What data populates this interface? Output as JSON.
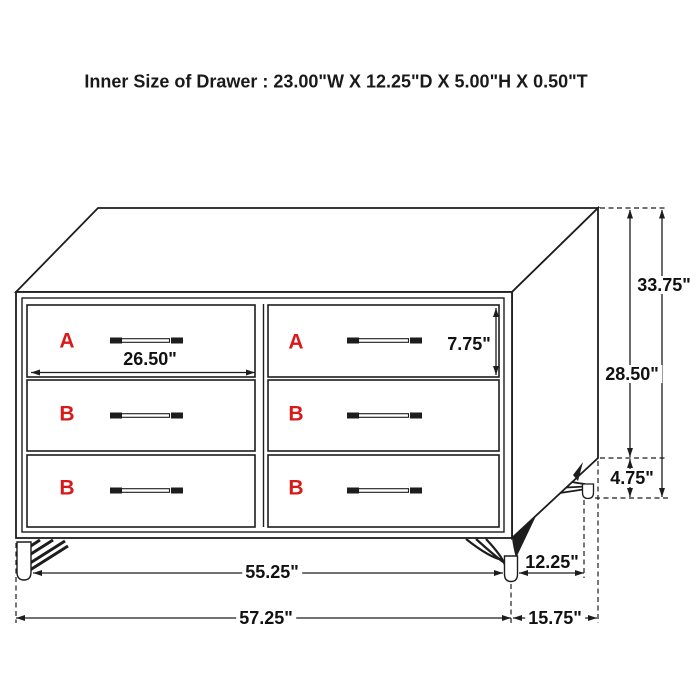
{
  "title": "Inner Size of Drawer : 23.00\"W X 12.25\"D X 5.00\"H X 0.50\"T",
  "drawers": [
    {
      "position": "top-left",
      "label": "A"
    },
    {
      "position": "top-right",
      "label": "A"
    },
    {
      "position": "middle-left",
      "label": "B"
    },
    {
      "position": "middle-right",
      "label": "B"
    },
    {
      "position": "bottom-left",
      "label": "B"
    },
    {
      "position": "bottom-right",
      "label": "B"
    }
  ],
  "dimensions": {
    "drawer_front_width": "26.50\"",
    "top_drawer_front_height": "7.75\"",
    "case_height_without_legs": "28.50\"",
    "overall_height": "33.75\"",
    "leg_height": "4.75\"",
    "front_leg_spacing": "55.25\"",
    "leg_depth_spacing": "12.25\"",
    "overall_width": "57.25\"",
    "overall_depth": "15.75\""
  },
  "colors": {
    "line": "#1d1d1d",
    "drawer_label_red": "#d81a1a",
    "background": "#ffffff"
  }
}
